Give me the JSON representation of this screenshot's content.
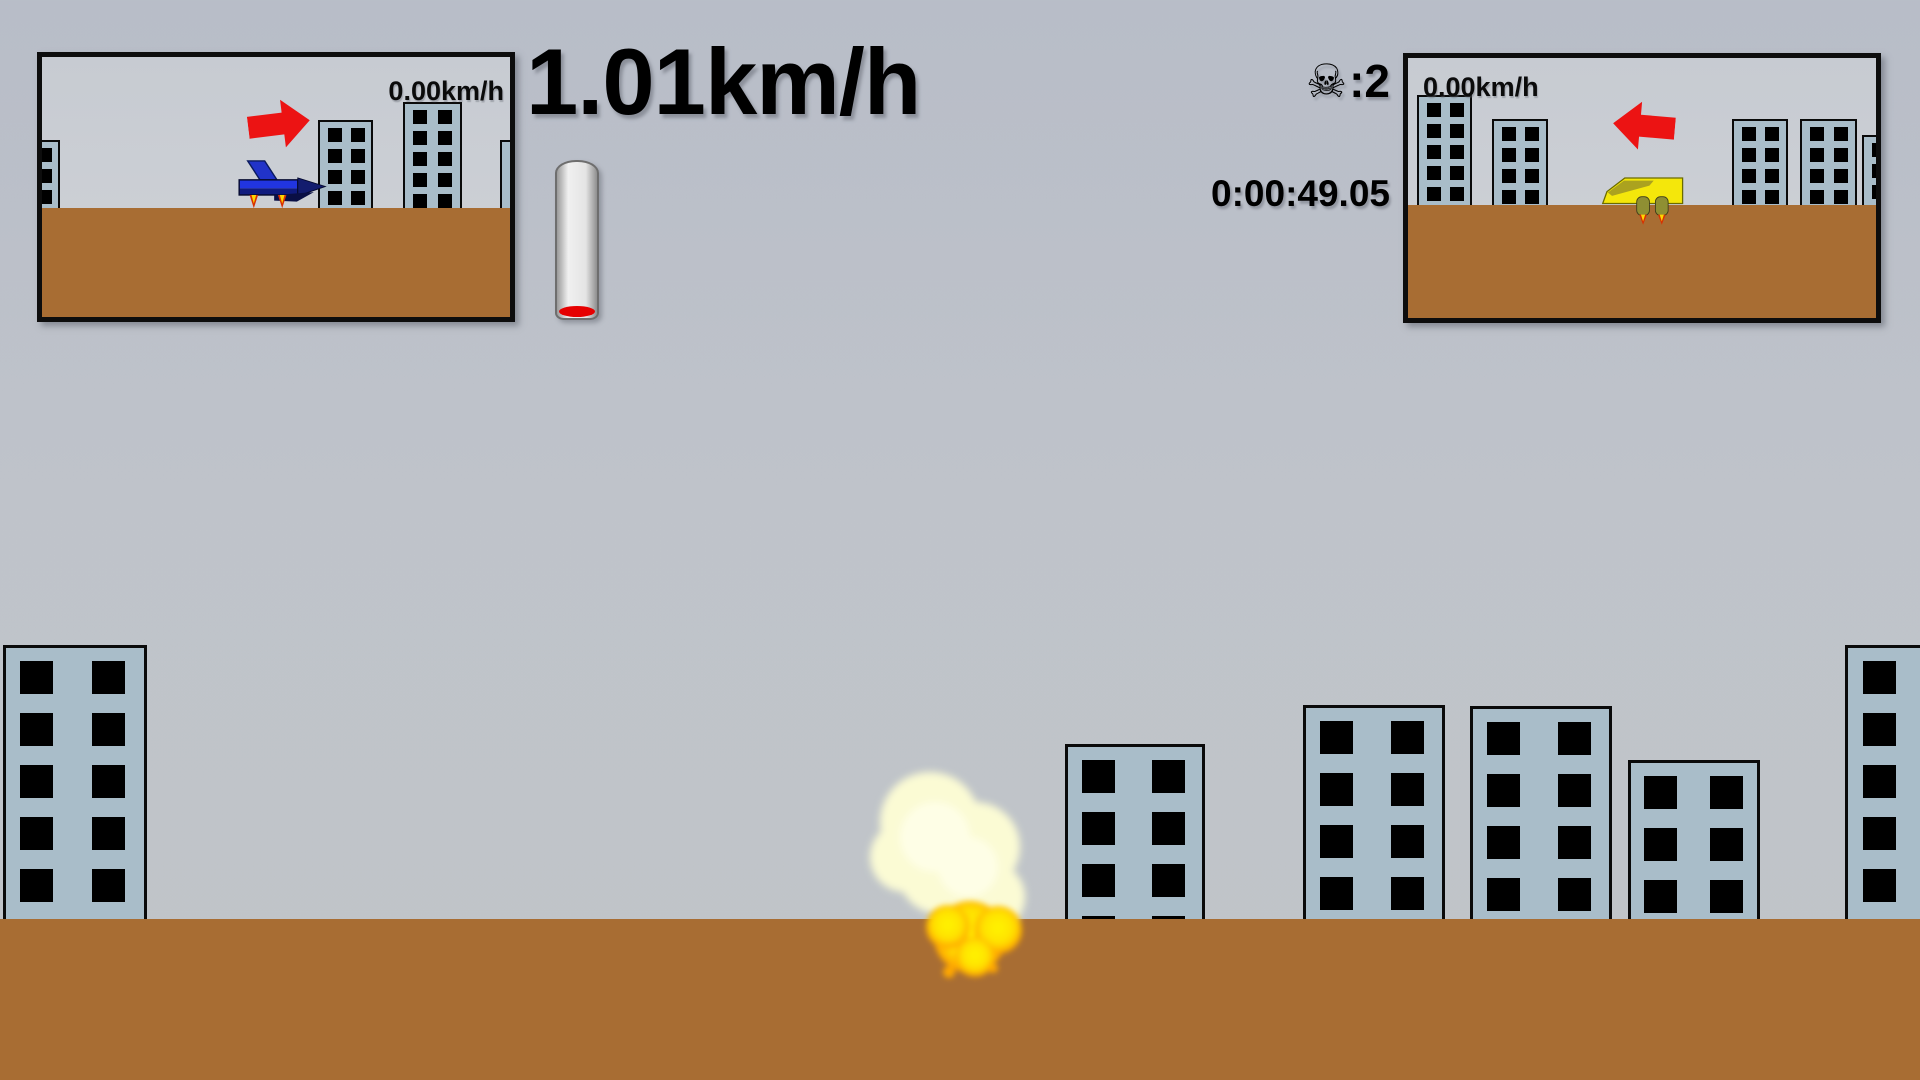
{
  "hud": {
    "speed": "1.01km/h",
    "deaths": {
      "icon": "☠",
      "separator": ": ",
      "value": "2"
    },
    "timer": "0:00:49.05"
  },
  "minimap_left": {
    "speed": "0.00km/h",
    "arrow": "right",
    "vehicle": "blue-jet",
    "ground_top": 151,
    "buildings": [
      {
        "x": -37,
        "top": 83,
        "w": 55,
        "rows": 3
      },
      {
        "x": 276,
        "top": 63,
        "w": 55,
        "rows": 4
      },
      {
        "x": 361,
        "top": 45,
        "w": 59,
        "rows": 5
      },
      {
        "x": 458,
        "top": 83,
        "w": 55,
        "rows": 3
      }
    ]
  },
  "minimap_right": {
    "speed": "0.00km/h",
    "arrow": "left",
    "vehicle": "yellow-hovervan",
    "ground_top": 147,
    "buildings": [
      {
        "x": 9,
        "top": 37,
        "w": 55,
        "rows": 5
      },
      {
        "x": 84,
        "top": 61,
        "w": 56,
        "rows": 4
      },
      {
        "x": 324,
        "top": 61,
        "w": 56,
        "rows": 4
      },
      {
        "x": 392,
        "top": 61,
        "w": 57,
        "rows": 4
      },
      {
        "x": 454,
        "top": 77,
        "w": 55,
        "rows": 3
      }
    ]
  },
  "scene": {
    "ground_top": 919,
    "buildings": [
      {
        "x": 3,
        "top": 645,
        "w": 144,
        "rows": 5
      },
      {
        "x": 1065,
        "top": 744,
        "w": 140,
        "rows": 4
      },
      {
        "x": 1303,
        "top": 705,
        "w": 142,
        "rows": 4
      },
      {
        "x": 1470,
        "top": 706,
        "w": 142,
        "rows": 4
      },
      {
        "x": 1628,
        "top": 760,
        "w": 132,
        "rows": 3
      },
      {
        "x": 1845,
        "top": 645,
        "w": 145,
        "rows": 5
      }
    ],
    "explosion": {
      "x": 960,
      "y": 880
    }
  },
  "colors": {
    "ground": "#A86D33",
    "building_fill": "#A9BDC9",
    "building_window": "#000000",
    "arrow_red": "#EC1313",
    "gauge_red": "#E60000",
    "jet_blue": "#2135E0",
    "jet_dark": "#131C6E",
    "vehicle_yellow": "#F4E70B",
    "vehicle_olive": "#8F8F33",
    "explosion_cloud": "#FBFBD4",
    "explosion_core": "#FFF400",
    "explosion_fringe": "#FFA800",
    "flame_red": "#D83000",
    "flame_yellow": "#FFD500"
  }
}
